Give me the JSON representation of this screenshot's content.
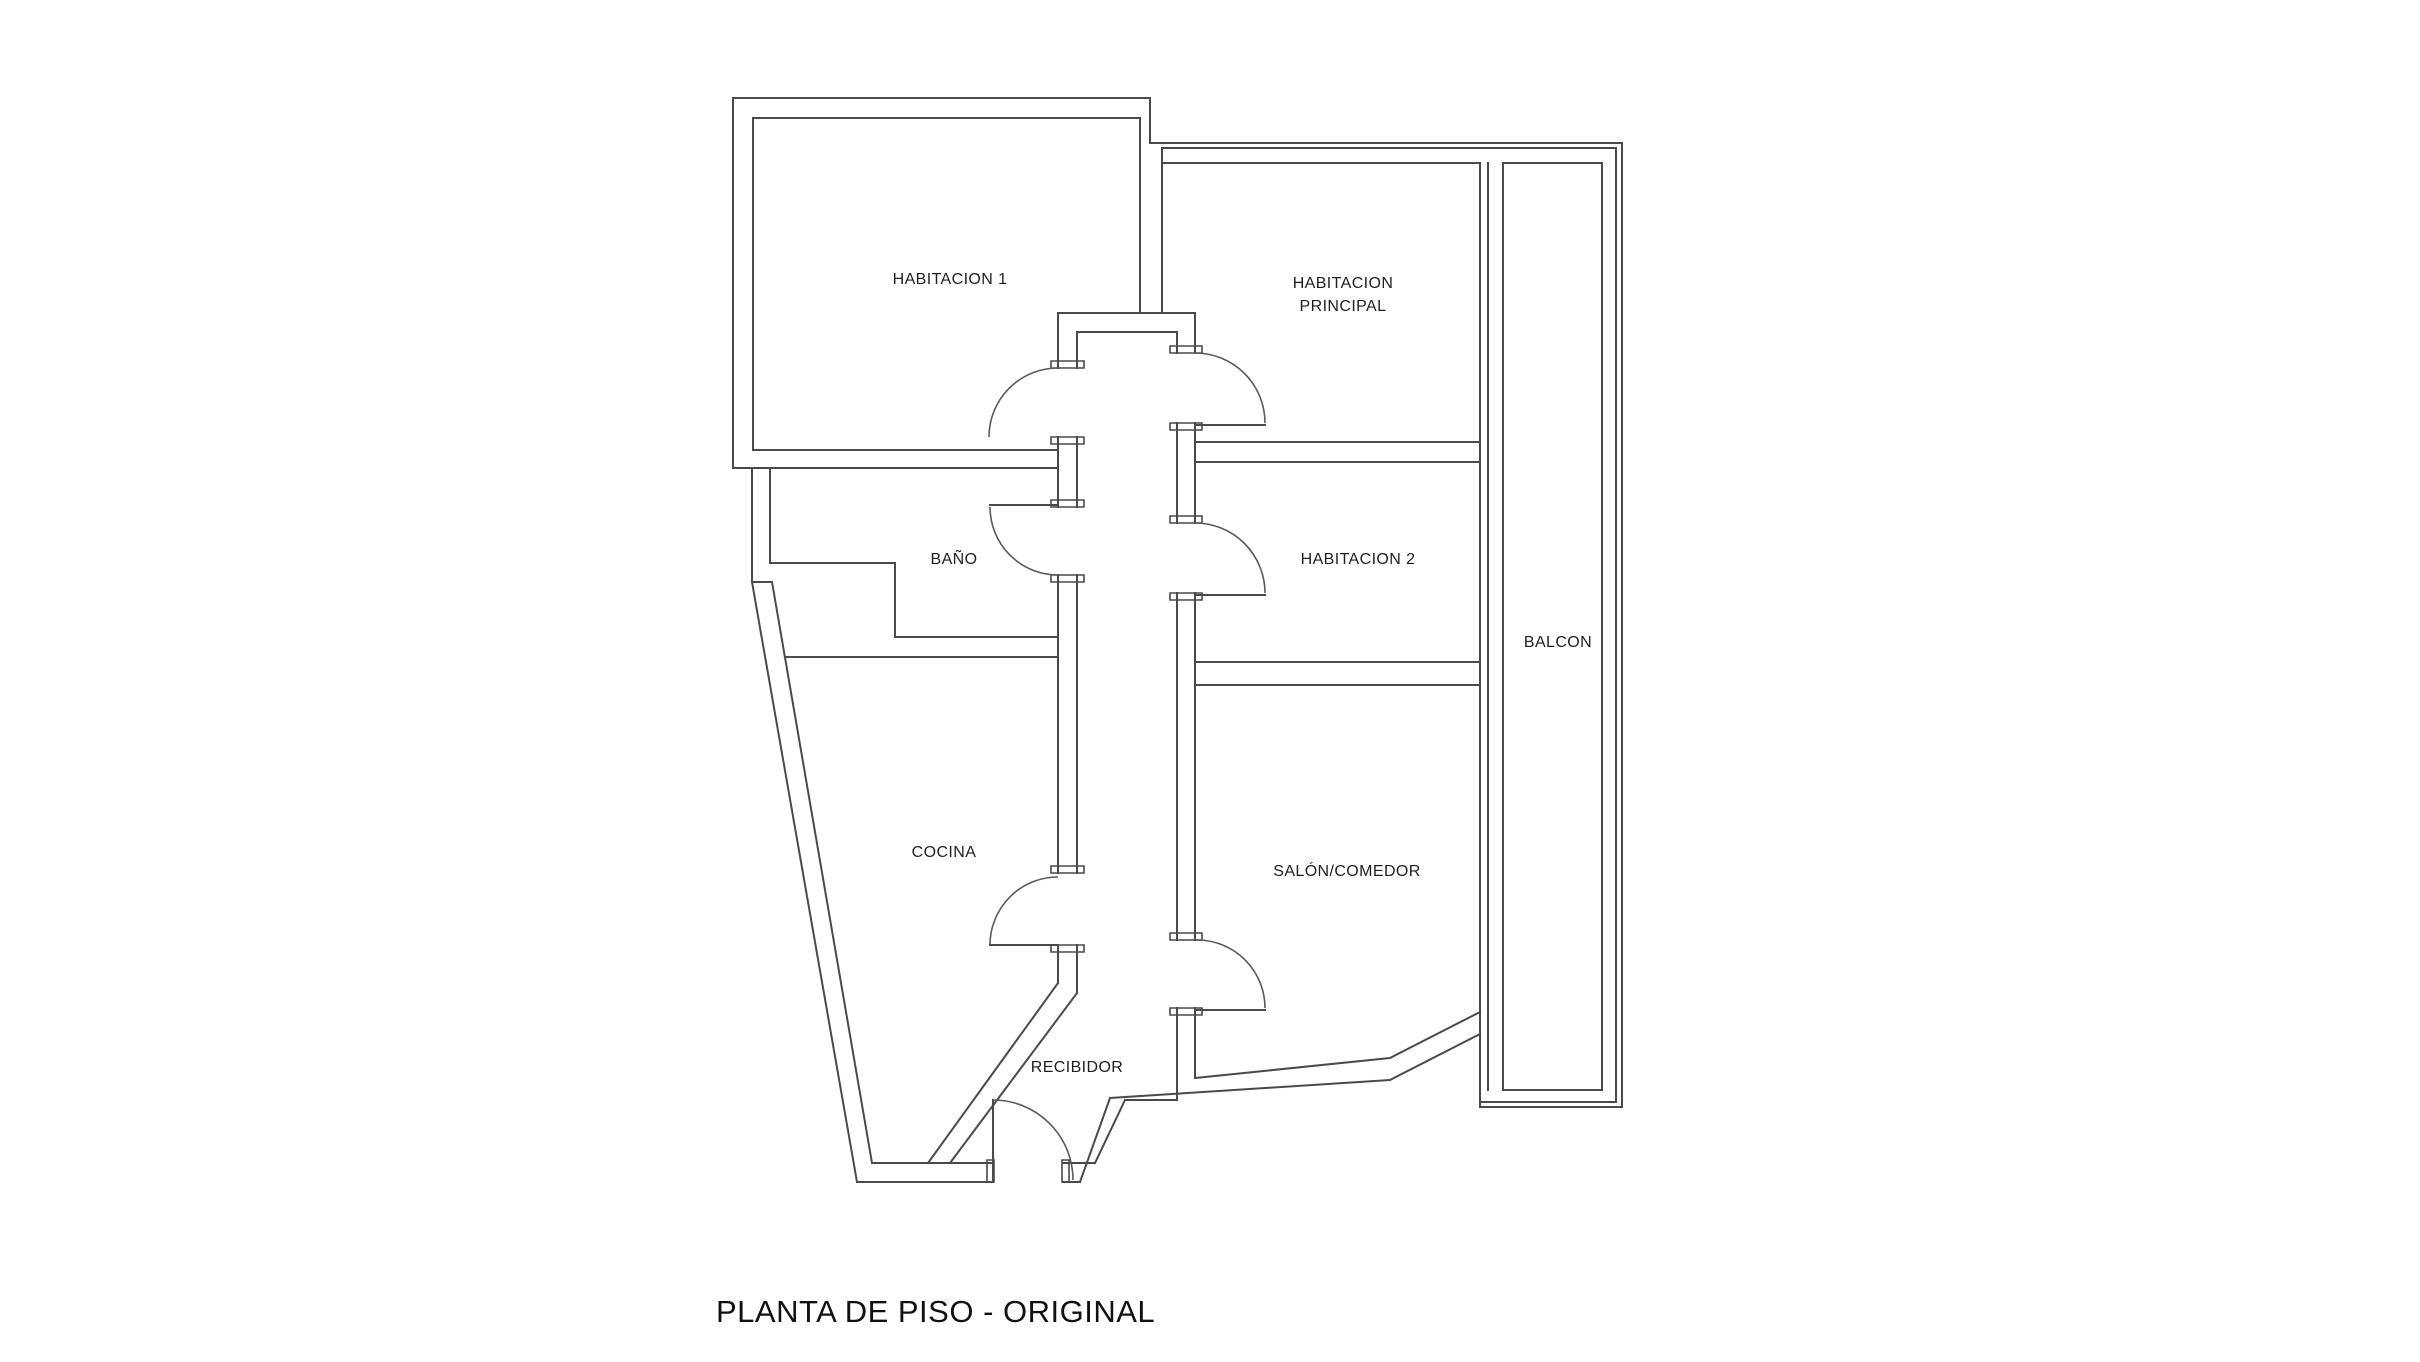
{
  "colors": {
    "background": "#ffffff",
    "wall_line": "#4a4a4a",
    "text": "#1f1f1f"
  },
  "title": {
    "text": "PLANTA DE PISO - ORIGINAL"
  },
  "rooms": [
    {
      "name": "habitacion-1",
      "label": "HABITACION 1"
    },
    {
      "name": "habitacion-principal",
      "label_line1": "HABITACION",
      "label_line2": "PRINCIPAL"
    },
    {
      "name": "habitacion-2",
      "label": "HABITACION 2"
    },
    {
      "name": "bano",
      "label": "BAÑO"
    },
    {
      "name": "balcon",
      "label": "BALCON"
    },
    {
      "name": "cocina",
      "label": "COCINA"
    },
    {
      "name": "salon-comedor",
      "label": "SALÓN/COMEDOR"
    },
    {
      "name": "recibidor",
      "label": "RECIBIDOR"
    }
  ]
}
